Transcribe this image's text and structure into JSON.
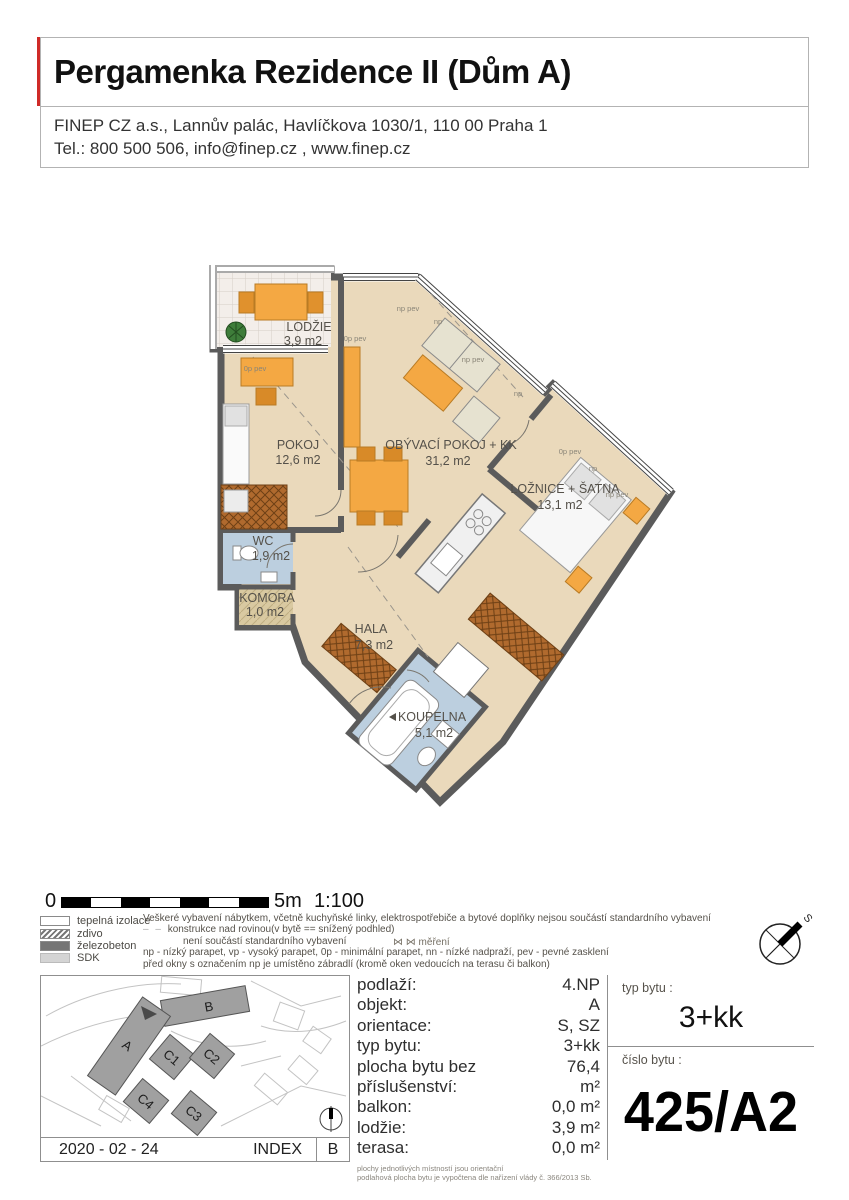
{
  "header": {
    "title": "Pergamenka Rezidence II (Dům A)",
    "address_line1": "FINEP CZ a.s., Lannův palác, Havlíčkova 1030/1, 110 00 Praha 1",
    "address_line2": "Tel.: 800 500 506, info@finep.cz , www.finep.cz"
  },
  "plan": {
    "rooms": [
      {
        "name": "LODŽIE",
        "area": "3,9 m2"
      },
      {
        "name": "POKOJ",
        "area": "12,6 m2"
      },
      {
        "name": "OBÝVACÍ POKOJ + KK",
        "area": "31,2 m2"
      },
      {
        "name": "LOŽNICE + ŠATNA",
        "area": "13,1 m2"
      },
      {
        "name": "WC",
        "area": "1,9 m2"
      },
      {
        "name": "KOMORA",
        "area": "1,0 m2"
      },
      {
        "name": "HALA",
        "area": "7,3 m2"
      },
      {
        "name": "KOUPELNA",
        "area": "5,1 m2"
      }
    ],
    "annotations": [
      {
        "text": "np pev"
      },
      {
        "text": "np"
      },
      {
        "text": "np pev"
      },
      {
        "text": "np"
      },
      {
        "text": "0p pev"
      },
      {
        "text": "np"
      },
      {
        "text": "np pev"
      },
      {
        "text": "0p pev"
      },
      {
        "text": "0p pev"
      }
    ]
  },
  "scale": {
    "zero": "0",
    "five": "5m",
    "ratio": "1:100"
  },
  "legend": {
    "items": [
      {
        "label": "tepelná izolace"
      },
      {
        "label": "zdivo"
      },
      {
        "label": "železobeton"
      },
      {
        "label": "SDK"
      }
    ]
  },
  "notes": {
    "line1": "Veškeré vybavení nábytkem, včetně kuchyňské linky, elektrospotřebiče a bytové doplňky nejsou součástí standardního vybavení",
    "line2": "konstrukce nad rovinou(v bytě == snížený podhled)",
    "mereni": "⋈ ⋈  měření",
    "line3": "není součástí standardního vybavení",
    "line4": "np - nízký parapet, vp - vysoký parapet, 0p - minimální parapet, nn - nízké nadpraží, pev - pevné zasklení",
    "line5": "před okny s označením np je umístěno zábradlí (kromě oken vedoucích na terasu či balkon)"
  },
  "compass": {
    "north_label": "S"
  },
  "sitemap": {
    "buildings": [
      "B",
      "A",
      "C1",
      "C2",
      "C4",
      "C3"
    ],
    "date": "2020 - 02 - 24",
    "index_label": "INDEX",
    "index_value": "B"
  },
  "info": {
    "rows": [
      {
        "label": "podlaží:",
        "value": "4.NP"
      },
      {
        "label": "objekt:",
        "value": "A"
      },
      {
        "label": "orientace:",
        "value": "S, SZ"
      },
      {
        "label": "typ bytu:",
        "value": "3+kk"
      },
      {
        "label": "plocha bytu bez příslušenství:",
        "value": "76,4 m²"
      },
      {
        "label": "balkon:",
        "value": "0,0 m²"
      },
      {
        "label": "lodžie:",
        "value": "3,9 m²"
      },
      {
        "label": "terasa:",
        "value": "0,0 m²"
      }
    ],
    "fine_print1": "plochy jednotlivých místností jsou orientační",
    "fine_print2": "podlahová plocha bytu je vypočtena dle nařízení vlády č. 366/2013 Sb."
  },
  "unit": {
    "type_label": "typ bytu :",
    "type_value": "3+kk",
    "number_label": "číslo bytu :",
    "number_value": "425/A2"
  },
  "colors": {
    "accent_red": "#cf2a27",
    "floor_tan": "#ead9bb",
    "wet_blue": "#bccfdf",
    "furniture_orange": "#f4a843"
  }
}
